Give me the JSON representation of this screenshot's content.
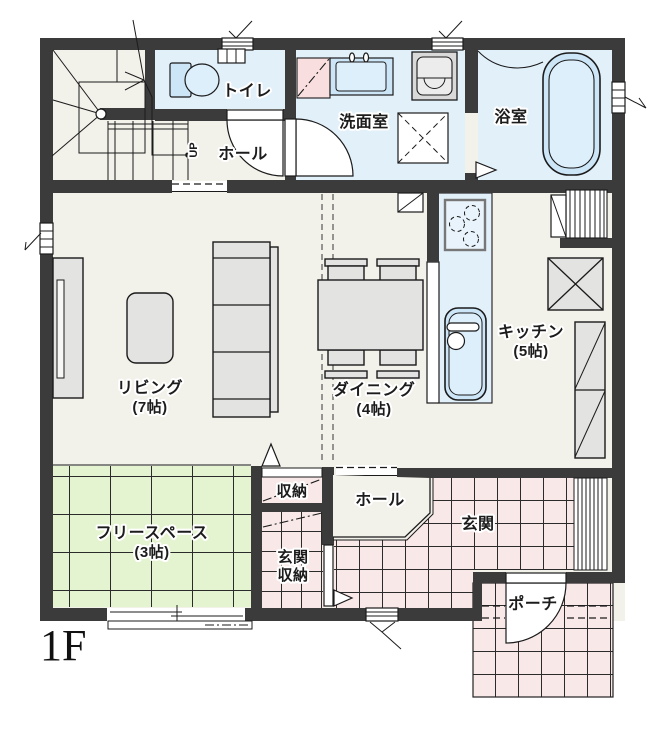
{
  "title": "1F floor plan",
  "floor_indicator": "1F",
  "stairs": {
    "direction_label": "UP"
  },
  "rooms": {
    "toilet": {
      "label": "トイレ"
    },
    "washroom": {
      "label": "洗面室"
    },
    "bath": {
      "label": "浴室"
    },
    "hall_upper": {
      "label": "ホール"
    },
    "living": {
      "label": "リビング",
      "size": "(7帖)"
    },
    "dining": {
      "label": "ダイニング",
      "size": "(4帖)"
    },
    "kitchen": {
      "label": "キッチン",
      "size": "(5帖)"
    },
    "free_space": {
      "label": "フリースペース",
      "size": "(3帖)"
    },
    "storage": {
      "label": "収納"
    },
    "entrance_storage": {
      "label_line1": "玄関",
      "label_line2": "収納"
    },
    "hall_lower": {
      "label": "ホール"
    },
    "entrance": {
      "label": "玄関"
    },
    "porch": {
      "label": "ポーチ"
    }
  },
  "colors": {
    "wall": "#3b3b3b",
    "floor": "#f2f1ea",
    "water_room": "#e2f0fa",
    "water_fixture": "#cde6f7",
    "water_light": "#ddeffb",
    "tatami_green": "#e5f4d0",
    "tile_pink": "#f9e8e8",
    "fixture_pink": "#f8dede",
    "furniture_gray": "#e3e3e1",
    "outline": "#1b1b1b"
  }
}
